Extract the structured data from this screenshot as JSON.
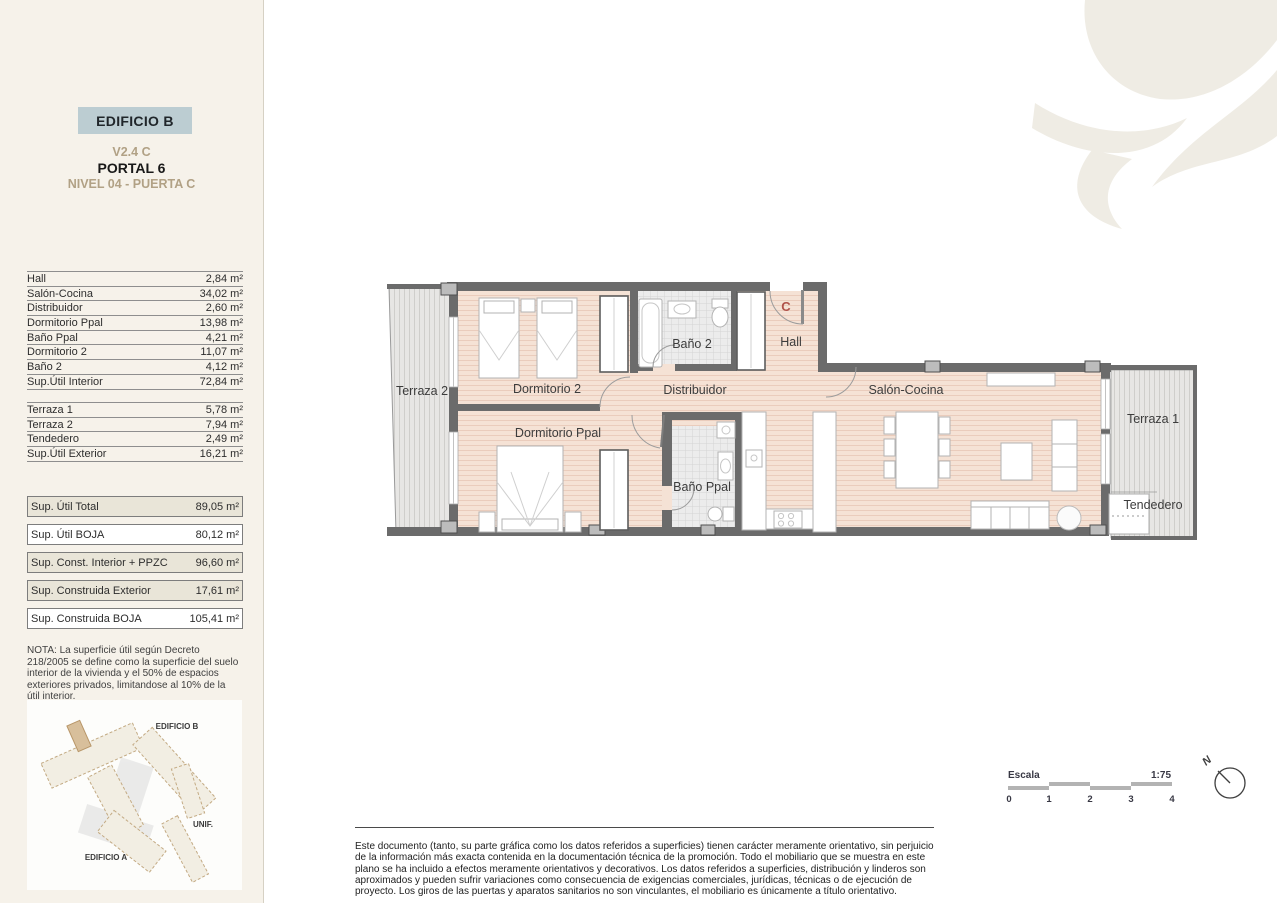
{
  "header": {
    "building": "EDIFICIO B",
    "unit": "V2.4 C",
    "portal": "PORTAL 6",
    "level": "NIVEL 04 - PUERTA C"
  },
  "tables": {
    "interior": [
      {
        "label": "Hall",
        "value": "2,84 m²"
      },
      {
        "label": "Salón-Cocina",
        "value": "34,02 m²"
      },
      {
        "label": "Distribuidor",
        "value": "2,60 m²"
      },
      {
        "label": "Dormitorio Ppal",
        "value": "13,98 m²"
      },
      {
        "label": "Baño Ppal",
        "value": "4,21 m²"
      },
      {
        "label": "Dormitorio 2",
        "value": "11,07 m²"
      },
      {
        "label": "Baño 2",
        "value": "4,12 m²"
      },
      {
        "label": "Sup.Útil Interior",
        "value": "72,84 m²"
      }
    ],
    "exterior": [
      {
        "label": "Terraza 1",
        "value": "5,78 m²"
      },
      {
        "label": "Terraza 2",
        "value": "7,94 m²"
      },
      {
        "label": "Tendedero",
        "value": "2,49 m²"
      },
      {
        "label": "Sup.Útil Exterior",
        "value": "16,21 m²"
      }
    ]
  },
  "summary": [
    {
      "label": "Sup. Útil Total",
      "value": "89,05 m²"
    },
    {
      "label": "Sup. Útil BOJA",
      "value": "80,12 m²"
    },
    {
      "label": "Sup. Const. Interior + PPZC",
      "value": "96,60 m²"
    },
    {
      "label": "Sup. Construida Exterior",
      "value": "17,61 m²"
    },
    {
      "label": "Sup. Construida BOJA",
      "value": "105,41 m²"
    }
  ],
  "note": "NOTA: La superficie útil según Decreto 218/2005 se define como la superficie del suelo interior de la vivienda y el 50% de espacios exteriores privados, limitandose al 10% de la útil interior.",
  "locator": {
    "edificio_b": "EDIFICIO B",
    "unif": "UNIF.",
    "edificio_a": "EDIFICIO A"
  },
  "plan": {
    "labels": {
      "terraza2": "Terraza 2",
      "dormitorio2": "Dormitorio 2",
      "dormitorio_ppal": "Dormitorio Ppal",
      "banio2": "Baño 2",
      "hall": "Hall",
      "distribuidor": "Distribuidor",
      "banio_ppal": "Baño Ppal",
      "salon_cocina": "Salón-Cocina",
      "terraza1": "Terraza 1",
      "tendedero": "Tendedero",
      "entrance_mark": "C"
    }
  },
  "scale": {
    "label": "Escala",
    "ratio": "1:75",
    "ticks": [
      "0",
      "1",
      "2",
      "3",
      "4"
    ]
  },
  "compass": {
    "north": "N"
  },
  "disclaimer": "Este documento (tanto, su parte gráfica como los datos referidos a superficies) tienen carácter meramente orientativo, sin perjuicio de la información más exacta contenida en la documentación técnica de la promoción. Todo el mobiliario que se muestra en este plano se ha incluido a efectos meramente orientativos y decorativos. Los datos referidos a superficies, distribución y linderos son aproximados y pueden sufrir variaciones como consecuencia de exigencias comerciales, jurídicas, técnicas o de ejecución de proyecto. Los giros de las puertas y aparatos sanitarios no son vinculantes, el mobiliario es únicamente a título orientativo.",
  "theme": {
    "sidebar_bg": "#f6f2ea",
    "panel_box": "#bccdd2",
    "gold": "#b1a185",
    "beige": "#e9e5d8",
    "wall": "#6b6b6b",
    "wood": "#f5e2d5",
    "wood_stripe": "#eaccbc",
    "deck": "#e7e6e4",
    "deck_stripe": "#cfcecb",
    "tile": "#ececec",
    "tile_grid": "#d4d4d4",
    "entry_mark": "#b0524a",
    "map_fill": "#f2eee3",
    "map_stroke": "#c3aa83",
    "map_highlight": "#d8bf9b",
    "logo": "#efece4"
  }
}
